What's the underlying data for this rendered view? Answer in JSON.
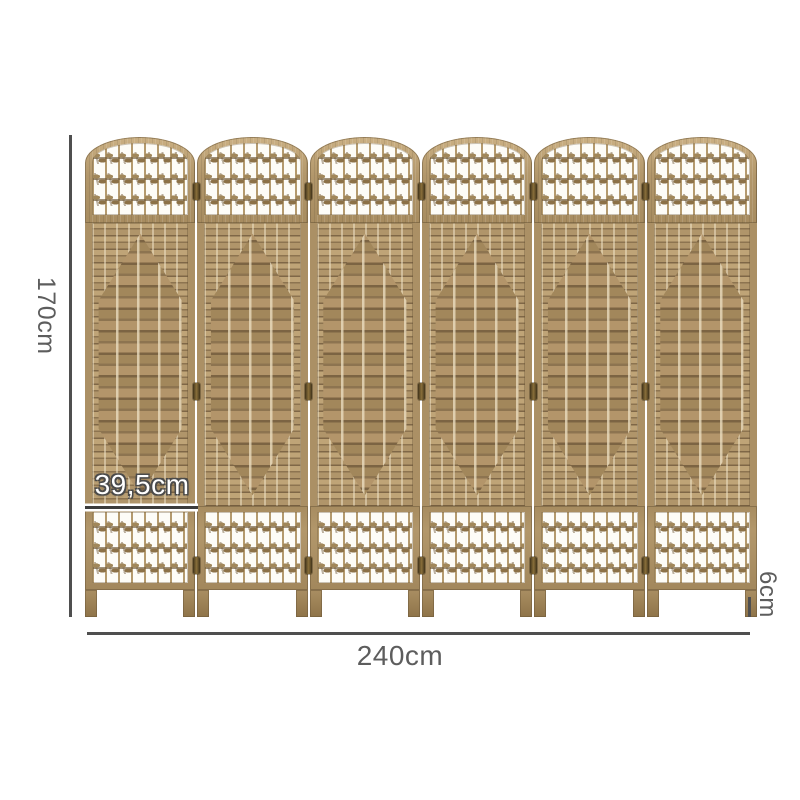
{
  "structure": {
    "panel_count": 6,
    "knot_rows_per_section": 3,
    "hinge_rows": 3
  },
  "dimensions": {
    "height": "170cm",
    "width": "240cm",
    "panel_width": "39,5cm",
    "depth": "6cm"
  },
  "colors": {
    "wood": "#b2976b",
    "wood_light": "#cbb083",
    "wood_dark": "#7a6344",
    "weave_dark": "#8d7450",
    "knot": "#a1875a",
    "hinge": "#8a6f3a",
    "dimension_line": "#4f4f4f",
    "label_text": "#5d5d5d",
    "background": "#ffffff"
  }
}
